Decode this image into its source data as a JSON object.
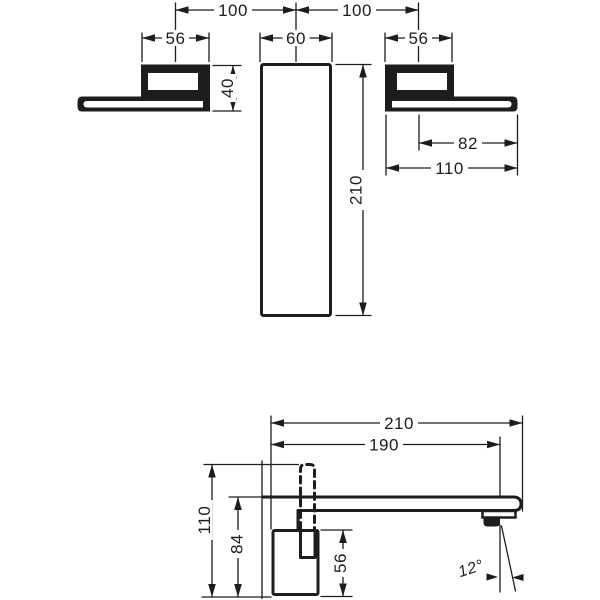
{
  "drawing": {
    "bg": "#ffffff",
    "ink": "#1d1d1b",
    "description": "Wall-mounted basin mixer installation dimensions, front and side views"
  },
  "front_view": {
    "left_spacing": "100",
    "right_spacing": "100",
    "left_handle_width": "56",
    "spout_plate_width": "60",
    "right_handle_width": "56",
    "handle_height": "40",
    "spout_plate_height": "210",
    "lever_reach": "82",
    "handle_reach": "110"
  },
  "side_view": {
    "spout_reach": "210",
    "aerator_offset": "190",
    "overall_height": "110",
    "below_spout_height": "84",
    "valve_body_height": "56",
    "spray_angle": "12°"
  }
}
